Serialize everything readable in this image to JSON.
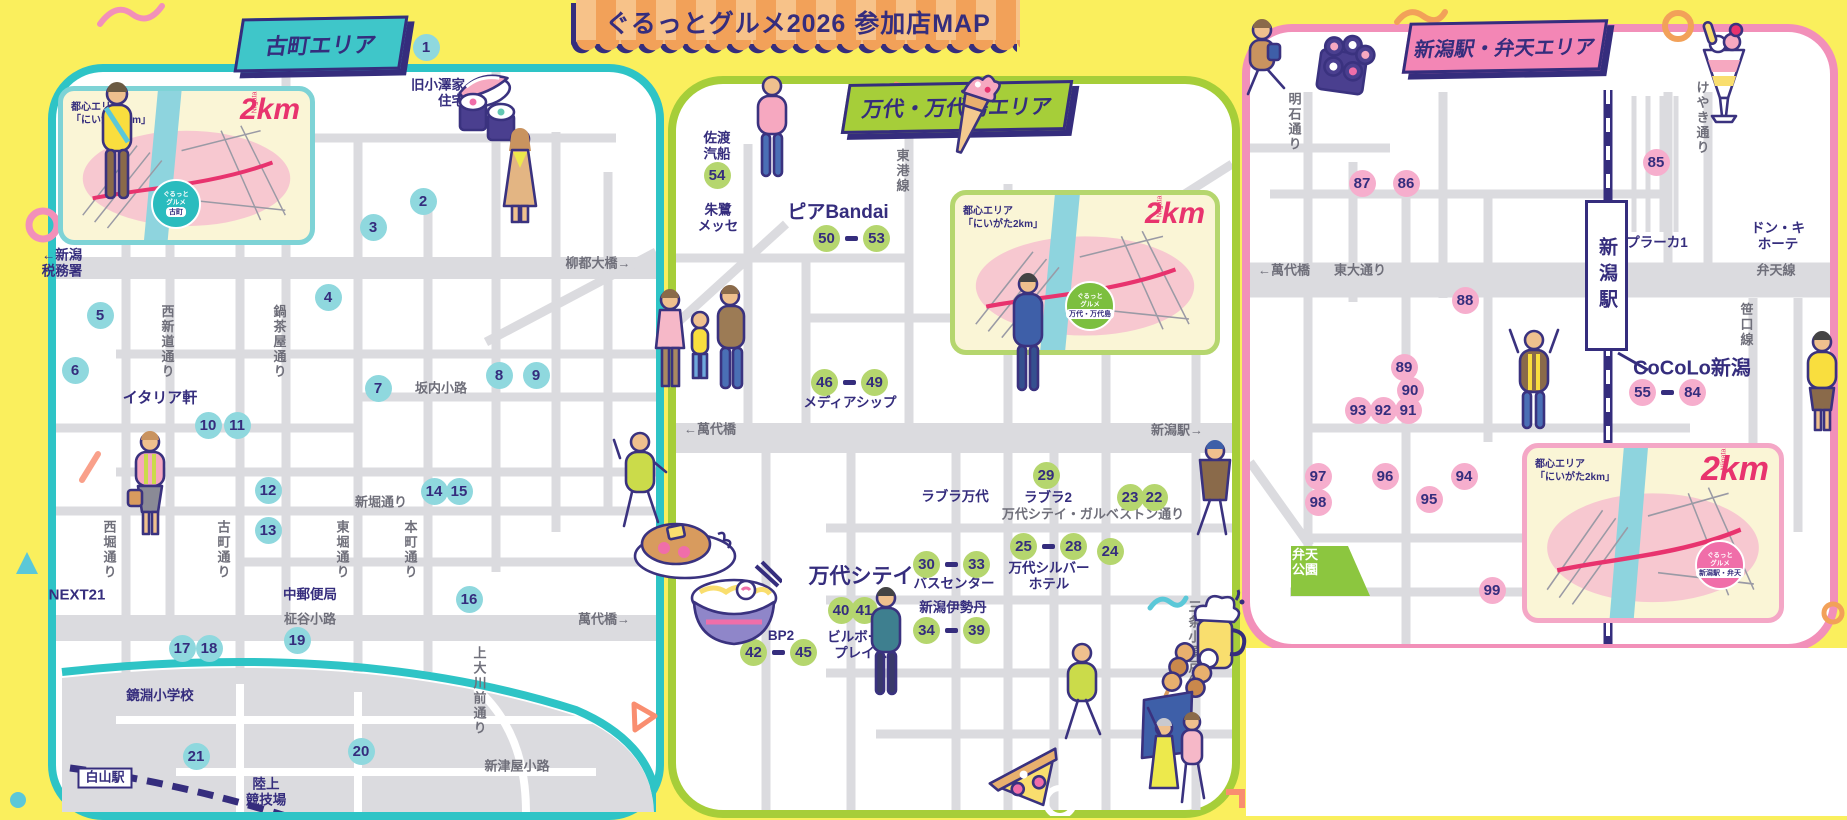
{
  "banner": {
    "title": "ぐるっとグルメ2026 参加店MAP"
  },
  "areas": {
    "furumachi": {
      "badge": "古町エリア",
      "accent": "#2EC4C6"
    },
    "bandai": {
      "badge": "万代・万代島エリア",
      "accent": "#A6CE39"
    },
    "station": {
      "badge": "新潟駅・弁天エリア",
      "accent": "#F290B9",
      "station_box": "新潟駅"
    }
  },
  "inset_maps": [
    {
      "area": "f",
      "label": "都心エリア\n「にいがた2km」",
      "logo": "2km",
      "logo_sub": "Niigata",
      "badge_logo": "ぐるっと\nグルメ",
      "badge_place": "古町"
    },
    {
      "area": "b",
      "label": "都心エリア\n「にいがた2km」",
      "logo": "2km",
      "logo_sub": "Niigata",
      "badge_logo": "ぐるっと\nグルメ",
      "badge_place": "万代・万代島"
    },
    {
      "area": "s",
      "label": "都心エリア\n「にいがた2km」",
      "logo": "2km",
      "logo_sub": "Niigata",
      "badge_logo": "ぐるっと\nグルメ",
      "badge_place": "新潟駅・弁天"
    }
  ],
  "markers": [
    {
      "n": "1",
      "a": "f",
      "x": 426,
      "y": 47
    },
    {
      "n": "2",
      "a": "f",
      "x": 423,
      "y": 201
    },
    {
      "n": "3",
      "a": "f",
      "x": 373,
      "y": 227
    },
    {
      "n": "4",
      "a": "f",
      "x": 328,
      "y": 297
    },
    {
      "n": "5",
      "a": "f",
      "x": 100,
      "y": 315
    },
    {
      "n": "6",
      "a": "f",
      "x": 75,
      "y": 370
    },
    {
      "n": "7",
      "a": "f",
      "x": 378,
      "y": 388
    },
    {
      "n": "8",
      "a": "f",
      "x": 499,
      "y": 375
    },
    {
      "n": "9",
      "a": "f",
      "x": 536,
      "y": 375
    },
    {
      "n": "10",
      "a": "f",
      "x": 208,
      "y": 425
    },
    {
      "n": "11",
      "a": "f",
      "x": 237,
      "y": 425
    },
    {
      "n": "12",
      "a": "f",
      "x": 268,
      "y": 490
    },
    {
      "n": "13",
      "a": "f",
      "x": 268,
      "y": 530
    },
    {
      "n": "14",
      "a": "f",
      "x": 434,
      "y": 491
    },
    {
      "n": "15",
      "a": "f",
      "x": 459,
      "y": 491
    },
    {
      "n": "16",
      "a": "f",
      "x": 469,
      "y": 599
    },
    {
      "n": "17",
      "a": "f",
      "x": 182,
      "y": 648
    },
    {
      "n": "18",
      "a": "f",
      "x": 209,
      "y": 648
    },
    {
      "n": "19",
      "a": "f",
      "x": 297,
      "y": 640
    },
    {
      "n": "20",
      "a": "f",
      "x": 361,
      "y": 751
    },
    {
      "n": "21",
      "a": "f",
      "x": 196,
      "y": 756
    },
    {
      "n": "54",
      "a": "b",
      "x": 717,
      "y": 175
    },
    {
      "n": "50",
      "to": "53",
      "a": "b",
      "x": 852,
      "y": 238
    },
    {
      "n": "46",
      "to": "49",
      "a": "b",
      "x": 850,
      "y": 382
    },
    {
      "n": "29",
      "a": "b",
      "x": 1046,
      "y": 475
    },
    {
      "n": "23",
      "a": "b",
      "x": 1130,
      "y": 497
    },
    {
      "n": "22",
      "a": "b",
      "x": 1154,
      "y": 497
    },
    {
      "n": "25",
      "to": "28",
      "a": "b",
      "x": 1049,
      "y": 546
    },
    {
      "n": "24",
      "a": "b",
      "x": 1110,
      "y": 551
    },
    {
      "n": "30",
      "to": "33",
      "a": "b",
      "x": 952,
      "y": 564
    },
    {
      "n": "34",
      "to": "39",
      "a": "b",
      "x": 952,
      "y": 630
    },
    {
      "n": "40",
      "a": "b",
      "x": 841,
      "y": 610
    },
    {
      "n": "41",
      "a": "b",
      "x": 864,
      "y": 610
    },
    {
      "n": "42",
      "to": "45",
      "a": "b",
      "x": 779,
      "y": 652
    },
    {
      "n": "85",
      "a": "s",
      "x": 1656,
      "y": 162
    },
    {
      "n": "87",
      "a": "s",
      "x": 1362,
      "y": 183
    },
    {
      "n": "86",
      "a": "s",
      "x": 1406,
      "y": 183
    },
    {
      "n": "88",
      "a": "s",
      "x": 1465,
      "y": 300
    },
    {
      "n": "89",
      "a": "s",
      "x": 1404,
      "y": 367
    },
    {
      "n": "90",
      "a": "s",
      "x": 1410,
      "y": 390
    },
    {
      "n": "93",
      "a": "s",
      "x": 1358,
      "y": 410
    },
    {
      "n": "92",
      "a": "s",
      "x": 1383,
      "y": 410
    },
    {
      "n": "91",
      "a": "s",
      "x": 1408,
      "y": 410
    },
    {
      "n": "97",
      "a": "s",
      "x": 1318,
      "y": 476
    },
    {
      "n": "98",
      "a": "s",
      "x": 1318,
      "y": 502
    },
    {
      "n": "96",
      "a": "s",
      "x": 1385,
      "y": 476
    },
    {
      "n": "95",
      "a": "s",
      "x": 1429,
      "y": 499
    },
    {
      "n": "94",
      "a": "s",
      "x": 1464,
      "y": 476
    },
    {
      "n": "99",
      "a": "s",
      "x": 1492,
      "y": 590
    },
    {
      "n": "55",
      "to": "84",
      "a": "s",
      "x": 1668,
      "y": 392
    }
  ],
  "labels": [
    {
      "t": "旧小澤家\n住宅",
      "x": 438,
      "y": 93,
      "s": "landmark",
      "al": "r"
    },
    {
      "t": "←新潟\n税務署",
      "x": 62,
      "y": 263,
      "s": "landmark",
      "al": "l"
    },
    {
      "t": "イタリア軒",
      "x": 160,
      "y": 398,
      "s": "landmark",
      "fs": 15
    },
    {
      "t": "NEXT21",
      "x": 77,
      "y": 595,
      "s": "landmark",
      "fs": 15
    },
    {
      "t": "中郵便局",
      "x": 310,
      "y": 595,
      "s": "landmark"
    },
    {
      "t": "鏡淵小学校",
      "x": 160,
      "y": 696,
      "s": "landmark"
    },
    {
      "t": "陸上\n競技場",
      "x": 266,
      "y": 792,
      "s": "landmark"
    },
    {
      "t": "白山駅",
      "x": 105,
      "y": 778,
      "s": "box"
    },
    {
      "t": "柳都大橋→",
      "x": 598,
      "y": 264,
      "s": "street"
    },
    {
      "t": "萬代橋→",
      "x": 604,
      "y": 620,
      "s": "street"
    },
    {
      "t": "西新道通り",
      "x": 166,
      "y": 342,
      "s": "street",
      "v": true
    },
    {
      "t": "鍋茶屋通り",
      "x": 278,
      "y": 342,
      "s": "street",
      "v": true
    },
    {
      "t": "坂内小路",
      "x": 441,
      "y": 389,
      "s": "street"
    },
    {
      "t": "新堀通り",
      "x": 381,
      "y": 503,
      "s": "street"
    },
    {
      "t": "西堀通り",
      "x": 108,
      "y": 550,
      "s": "street",
      "v": true
    },
    {
      "t": "古町通り",
      "x": 222,
      "y": 550,
      "s": "street",
      "v": true
    },
    {
      "t": "東堀通り",
      "x": 341,
      "y": 550,
      "s": "street",
      "v": true
    },
    {
      "t": "本町通り",
      "x": 409,
      "y": 550,
      "s": "street",
      "v": true
    },
    {
      "t": "柾谷小路",
      "x": 310,
      "y": 620,
      "s": "street"
    },
    {
      "t": "上大川前通り",
      "x": 478,
      "y": 691,
      "s": "street",
      "v": true
    },
    {
      "t": "新津屋小路",
      "x": 517,
      "y": 767,
      "s": "street"
    },
    {
      "t": "佐渡\n汽船",
      "x": 717,
      "y": 146,
      "s": "landmark"
    },
    {
      "t": "朱鷺\nメッセ",
      "x": 718,
      "y": 218,
      "s": "landmark"
    },
    {
      "t": "ピアBandai",
      "x": 838,
      "y": 213,
      "s": "landmark",
      "fs": 19
    },
    {
      "t": "東港線",
      "x": 901,
      "y": 171,
      "s": "street",
      "v": true
    },
    {
      "t": "←萬代橋",
      "x": 710,
      "y": 430,
      "s": "street"
    },
    {
      "t": "新潟駅→",
      "x": 1177,
      "y": 431,
      "s": "street"
    },
    {
      "t": "メディアシップ",
      "x": 850,
      "y": 403,
      "s": "landmark"
    },
    {
      "t": "ラブラ万代",
      "x": 955,
      "y": 497,
      "s": "landmark"
    },
    {
      "t": "ラブラ2",
      "x": 1048,
      "y": 498,
      "s": "landmark"
    },
    {
      "t": "万代シテイ・ガルベストン通り",
      "x": 1093,
      "y": 515,
      "s": "street"
    },
    {
      "t": "万代シルバー\nホテル",
      "x": 1049,
      "y": 576,
      "s": "landmark"
    },
    {
      "t": "万代シテイ",
      "x": 861,
      "y": 577,
      "s": "landmark",
      "fs": 21
    },
    {
      "t": "バスセンター",
      "x": 954,
      "y": 584,
      "s": "landmark"
    },
    {
      "t": "新潟伊勢丹",
      "x": 953,
      "y": 608,
      "s": "landmark"
    },
    {
      "t": "ビルボード\nプレイス",
      "x": 861,
      "y": 645,
      "s": "landmark"
    },
    {
      "t": "BP2",
      "x": 781,
      "y": 636,
      "s": "landmark"
    },
    {
      "t": "三条小須戸線",
      "x": 1193,
      "y": 645,
      "s": "street",
      "v": true
    },
    {
      "t": "明石通り",
      "x": 1293,
      "y": 122,
      "s": "street",
      "v": true
    },
    {
      "t": "けやき通り",
      "x": 1701,
      "y": 118,
      "s": "street",
      "v": true
    },
    {
      "t": "←萬代橋",
      "x": 1284,
      "y": 271,
      "s": "street"
    },
    {
      "t": "東大通り",
      "x": 1360,
      "y": 271,
      "s": "street"
    },
    {
      "t": "プラーカ1",
      "x": 1657,
      "y": 243,
      "s": "landmark"
    },
    {
      "t": "ドン・キ\nホーテ",
      "x": 1778,
      "y": 236,
      "s": "landmark"
    },
    {
      "t": "弁天線",
      "x": 1776,
      "y": 271,
      "s": "street"
    },
    {
      "t": "笹口線",
      "x": 1745,
      "y": 325,
      "s": "street",
      "v": true
    },
    {
      "t": "CoCoLo新潟",
      "x": 1692,
      "y": 369,
      "s": "landmark",
      "fs": 20
    },
    {
      "t": "弁天\n公園",
      "x": 1305,
      "y": 563,
      "s": "park"
    }
  ]
}
